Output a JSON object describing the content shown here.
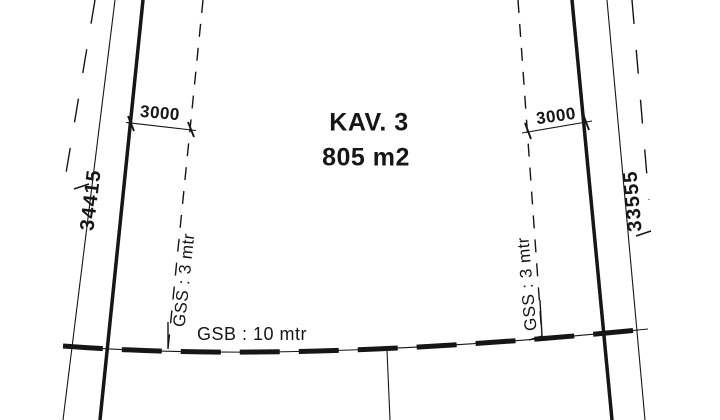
{
  "plot": {
    "title": "KAV. 3",
    "area": "805 m2"
  },
  "dimensions": {
    "top_left_width": "3000",
    "top_right_width": "3000",
    "left_side_length": "34415",
    "right_side_length": "33555"
  },
  "setback_labels": {
    "gss_left": "GSS : 3 mtr",
    "gss_right": "GSS : 3 mtr",
    "gsb": "GSB : 10 mtr"
  },
  "colors": {
    "ink": "#161616",
    "paper": "#ffffff"
  }
}
